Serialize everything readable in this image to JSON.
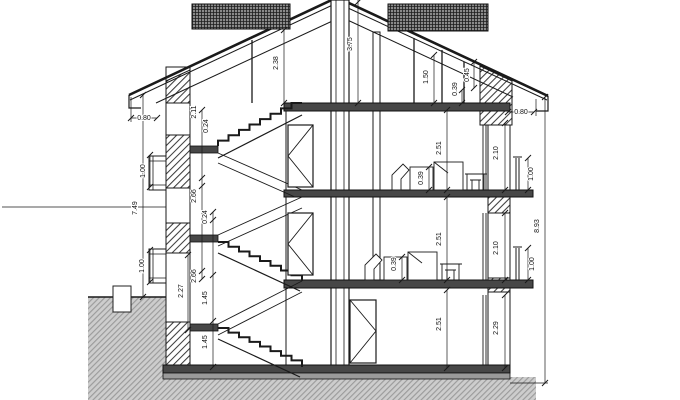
{
  "drawing": {
    "kind": "architectural-building-cross-section",
    "units": "m",
    "colors": {
      "line": "#1a1a1a",
      "slab": "#474747",
      "earth_fill": "#cdcdcd",
      "earth_line": "#9b9b9b",
      "roof_band": "#8a8a8a",
      "background": "#ffffff"
    },
    "labels": [
      {
        "text": "0.80",
        "x": 144,
        "y": 120,
        "rot": 0
      },
      {
        "text": "1.00",
        "x": 145,
        "y": 171,
        "rot": -90
      },
      {
        "text": "7.49",
        "x": 137,
        "y": 208,
        "rot": -90
      },
      {
        "text": "1.00",
        "x": 144,
        "y": 266,
        "rot": -90
      },
      {
        "text": "2.27",
        "x": 183,
        "y": 291,
        "rot": -90
      },
      {
        "text": "2.11",
        "x": 196,
        "y": 112,
        "rot": -90
      },
      {
        "text": "0.24",
        "x": 208,
        "y": 126,
        "rot": -90
      },
      {
        "text": "2.66",
        "x": 196,
        "y": 196,
        "rot": -90
      },
      {
        "text": "0.24",
        "x": 207,
        "y": 217,
        "rot": -90
      },
      {
        "text": "2.66",
        "x": 196,
        "y": 276,
        "rot": -90
      },
      {
        "text": "1.45",
        "x": 207,
        "y": 298,
        "rot": -90
      },
      {
        "text": "1.45",
        "x": 207,
        "y": 342,
        "rot": -90
      },
      {
        "text": "2.38",
        "x": 278,
        "y": 63,
        "rot": -90
      },
      {
        "text": "3.75",
        "x": 352,
        "y": 44,
        "rot": -90
      },
      {
        "text": "1.50",
        "x": 428,
        "y": 77,
        "rot": -90
      },
      {
        "text": "0.39",
        "x": 457,
        "y": 89,
        "rot": -90
      },
      {
        "text": "0.45",
        "x": 469,
        "y": 75,
        "rot": -90
      },
      {
        "text": "2.51",
        "x": 441,
        "y": 148,
        "rot": -90
      },
      {
        "text": "0.39",
        "x": 423,
        "y": 178,
        "rot": -90
      },
      {
        "text": "2.51",
        "x": 441,
        "y": 239,
        "rot": -90
      },
      {
        "text": "0.39",
        "x": 396,
        "y": 264,
        "rot": -90
      },
      {
        "text": "2.51",
        "x": 441,
        "y": 324,
        "rot": -90
      },
      {
        "text": "2.10",
        "x": 498,
        "y": 153,
        "rot": -90
      },
      {
        "text": "1.00",
        "x": 533,
        "y": 174,
        "rot": -90
      },
      {
        "text": "2.10",
        "x": 498,
        "y": 248,
        "rot": -90
      },
      {
        "text": "1.00",
        "x": 534,
        "y": 264,
        "rot": -90
      },
      {
        "text": "8.93",
        "x": 539,
        "y": 226,
        "rot": -90
      },
      {
        "text": "2.29",
        "x": 498,
        "y": 328,
        "rot": -90
      },
      {
        "text": "0.80",
        "x": 521,
        "y": 114,
        "rot": 0
      }
    ]
  }
}
